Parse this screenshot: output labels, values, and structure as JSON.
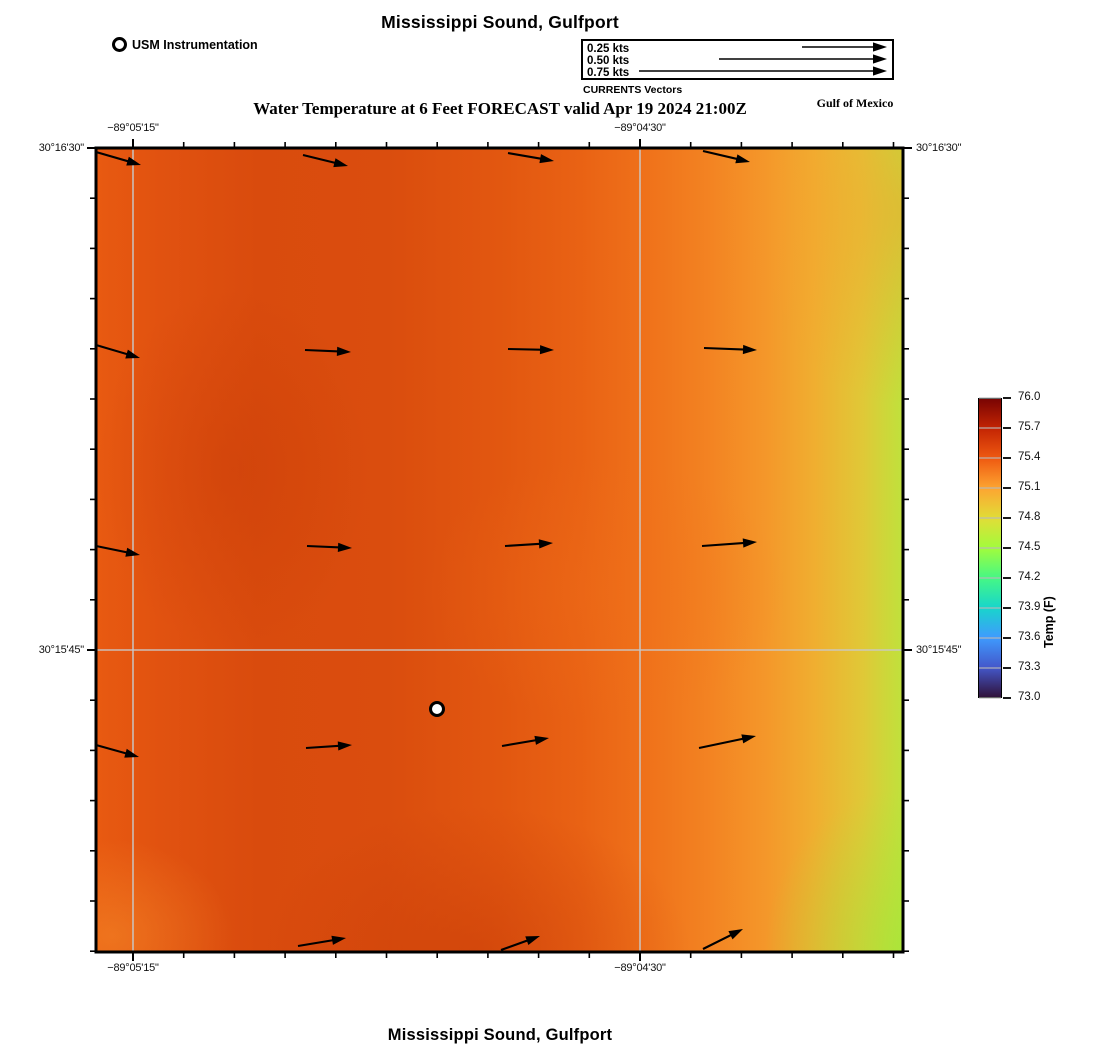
{
  "figure": {
    "title_top": "Mississippi Sound, Gulfport",
    "title_bottom": "Mississippi Sound, Gulfport",
    "subtitle": "Water Temperature at 6 Feet FORECAST valid Apr 19 2024 21:00Z",
    "region_label": "Gulf of Mexico",
    "station_legend_label": "USM Instrumentation",
    "vector_legend": {
      "caption": "CURRENTS Vectors",
      "entries": [
        {
          "label": "0.25 kts",
          "length_px": 85
        },
        {
          "label": "0.50 kts",
          "length_px": 168
        },
        {
          "label": "0.75 kts",
          "length_px": 248
        }
      ]
    }
  },
  "chart_data": {
    "type": "heatmap",
    "title": "Water Temperature at 6 Feet FORECAST valid Apr 19 2024 21:00Z",
    "location": "Mississippi Sound, Gulfport",
    "valid_time": "Apr 19 2024 21:00Z",
    "depth": "6 Feet",
    "colormap": "turbo",
    "colors": {
      "frame": "#000000",
      "gridline": "#c9c9c9",
      "arrow": "#000000",
      "station_fill": "#ffffff"
    },
    "colorbar": {
      "label": "Temp (F)",
      "min": 73.0,
      "max": 76.0,
      "tick_labels": [
        "76.0",
        "75.7",
        "75.4",
        "75.1",
        "74.8",
        "74.5",
        "74.2",
        "73.9",
        "73.6",
        "73.3",
        "73.0"
      ],
      "gradient_top_to_bottom": [
        "#7a0403",
        "#c42503",
        "#ef5a11",
        "#fda531",
        "#e1dd37",
        "#a2fc3c",
        "#46f884",
        "#18d6cb",
        "#3e9bfe",
        "#4458cb",
        "#30123b"
      ]
    },
    "axes": {
      "lon_ticks": [
        {
          "label": "−89°05'15\"",
          "rel_x": 37
        },
        {
          "label": "−89°04'30\"",
          "rel_x": 544
        }
      ],
      "lat_ticks": [
        {
          "label": "30°16'30\"",
          "rel_y": 0
        },
        {
          "label": "30°15'45\"",
          "rel_y": 502
        }
      ],
      "minor_step_x": 50.7,
      "minor_step_y": 50.2
    },
    "gridlines": {
      "vertical_rel_x": [
        37,
        544
      ],
      "horizontal_rel_y": [
        502
      ]
    },
    "temperature_field_estimate_F": {
      "note": "approximate values read from color field; rows top to bottom, columns left to right",
      "grid": [
        [
          75.4,
          75.5,
          75.45,
          75.25,
          75.0
        ],
        [
          75.45,
          75.55,
          75.4,
          75.3,
          74.9
        ],
        [
          75.45,
          75.5,
          75.4,
          75.3,
          74.85
        ],
        [
          75.4,
          75.5,
          75.45,
          75.3,
          74.8
        ],
        [
          75.35,
          75.45,
          75.55,
          75.3,
          74.6
        ]
      ]
    },
    "current_vectors_rel_px": [
      {
        "tail": [
          0,
          4
        ],
        "tip": [
          45,
          17
        ]
      },
      {
        "tail": [
          207,
          7
        ],
        "tip": [
          252,
          18
        ]
      },
      {
        "tail": [
          412,
          5
        ],
        "tip": [
          458,
          13
        ]
      },
      {
        "tail": [
          607,
          3
        ],
        "tip": [
          654,
          14
        ]
      },
      {
        "tail": [
          0,
          197
        ],
        "tip": [
          44,
          210
        ]
      },
      {
        "tail": [
          209,
          202
        ],
        "tip": [
          255,
          204
        ]
      },
      {
        "tail": [
          412,
          201
        ],
        "tip": [
          458,
          202
        ]
      },
      {
        "tail": [
          608,
          200
        ],
        "tip": [
          661,
          202
        ]
      },
      {
        "tail": [
          0,
          398
        ],
        "tip": [
          44,
          407
        ]
      },
      {
        "tail": [
          211,
          398
        ],
        "tip": [
          256,
          400
        ]
      },
      {
        "tail": [
          409,
          398
        ],
        "tip": [
          457,
          395
        ]
      },
      {
        "tail": [
          606,
          398
        ],
        "tip": [
          661,
          394
        ]
      },
      {
        "tail": [
          0,
          597
        ],
        "tip": [
          43,
          609
        ]
      },
      {
        "tail": [
          210,
          600
        ],
        "tip": [
          256,
          597
        ]
      },
      {
        "tail": [
          406,
          598
        ],
        "tip": [
          453,
          590
        ]
      },
      {
        "tail": [
          603,
          600
        ],
        "tip": [
          660,
          588
        ]
      },
      {
        "tail": [
          202,
          798
        ],
        "tip": [
          250,
          790
        ]
      },
      {
        "tail": [
          405,
          802
        ],
        "tip": [
          444,
          788
        ]
      },
      {
        "tail": [
          607,
          801
        ],
        "tip": [
          647,
          781
        ]
      }
    ],
    "station_marker_rel": {
      "x": 341,
      "y": 561
    },
    "layout": {
      "map": {
        "left": 96,
        "top": 148,
        "width": 807,
        "height": 804
      },
      "colorbar": {
        "left": 978,
        "top": 398,
        "width": 24,
        "height": 300
      }
    }
  }
}
